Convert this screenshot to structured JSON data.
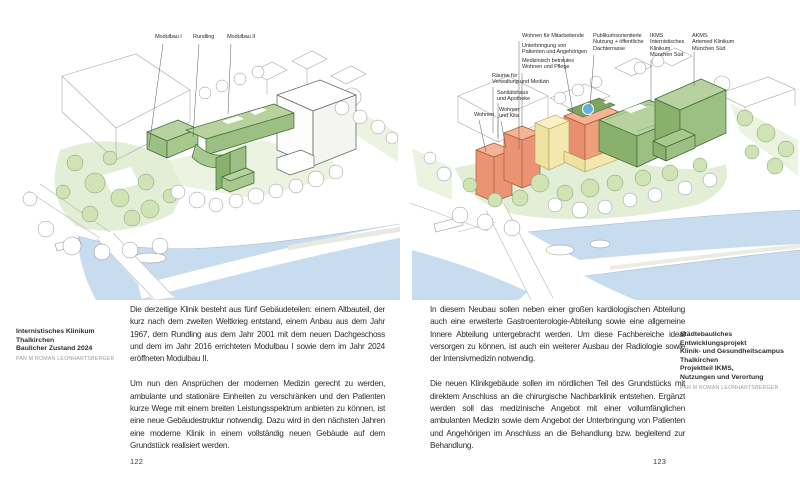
{
  "colors": {
    "existing_building_green": "#9cc083",
    "new_building_green": "#9cc083",
    "roof_garden_green": "#7ca361",
    "housing_orange": "#ea9474",
    "mixed_use_yellow": "#f4e8ae",
    "roof_pool_blue": "#62b0dc",
    "river_blue": "#c8dcf0",
    "park_green": "#e3eed6"
  },
  "left_page": {
    "labels": {
      "modulbau1": "Modulbau I",
      "rundling": "Rundling",
      "modulbau2": "Modulbau II"
    },
    "caption": {
      "main": "Internistisches Klinikum Thalkirchen\nBaulicher Zustand 2024",
      "credit": "PAN M ROMAN LEONHARTSBERGER"
    },
    "text": {
      "p1": "Die derzeitige Klinik besteht aus fünf Gebäudeteilen: einem Altbauteil, der kurz nach dem zweiten Weltkrieg entstand, einem Anbau aus dem Jahr 1967, dem Rundling aus dem Jahr 2001 mit dem neuen Dachgeschoss und dem im Jahr 2016 errichteten Modulbau I sowie dem im Jahr 2024 eröffneten Modulbau II.",
      "p2": "Um nun den Ansprüchen der modernen Medizin gerecht zu werden, ambulante und stationäre Einheiten zu verschränken und den Patienten kurze Wege mit einem breiten Leistungsspektrum anbieten zu können, ist eine neue Gebäudestruktur notwendig. Dazu wird in den nächsten Jahren eine moderne Klinik in einem vollständig neuen Gebäude auf dem Grundstück realisiert werden."
    },
    "page_number": "122"
  },
  "right_page": {
    "labels": {
      "wohnen_mitarbeitende": "Wohnen für Mitarbeitende",
      "unterbringung": "Unterbringung von\nPatienten und Angehörigen",
      "betreutes_wohnen": "Medizinisch betreutes\nWohnen und Pflege",
      "verwaltung": "Räume für\nVerwaltung und Medizin",
      "sanitaetshaus": "Sanitätshaus\nund Apotheke",
      "wohnen": "Wohnen",
      "wohnen_kita": "Wohnen\nund Kita",
      "publikum": "Publikumsorientierte\nNutzung + öffentliche\nDachterrasse",
      "ikms": "IKMS\nInternistisches\nKlinikum\nMünchen Süd",
      "akms": "AKMS\nArtemed Klinikum\nMünchen Süd"
    },
    "caption": {
      "main": "Städtebauliches Entwicklungsprojekt\nKlinik- und Gesundheitscampus\nThalkirchen\nProjektteil IKMS,\nNutzungen und Verortung",
      "credit": "PAN M ROMAN LEONHARTSBERGER"
    },
    "text": {
      "p1": "In diesem Neubau sollen neben einer großen kardiologischen Abteilung auch eine erweiterte Gastroenterologie-Abteilung sowie eine allgemeine Innere Abteilung untergebracht werden. Um diese Fachbereiche ideal versorgen zu können, ist auch ein weiterer Ausbau der Radiologie sowie der Intensivmedizin notwendig.",
      "p2": "Die neuen Klinikgebäude sollen im nördlichen Teil des Grundstücks mit direktem Anschluss an die chirurgische Nachbarklinik entstehen. Ergänzt werden soll das medizinische Angebot mit einer vollumfänglichen ambulanten Medizin sowie dem Angebot der Unterbringung von Patienten und Angehörigen im Anschluss an die Behandlung bzw. begleitend zur Behandlung."
    },
    "page_number": "123"
  }
}
